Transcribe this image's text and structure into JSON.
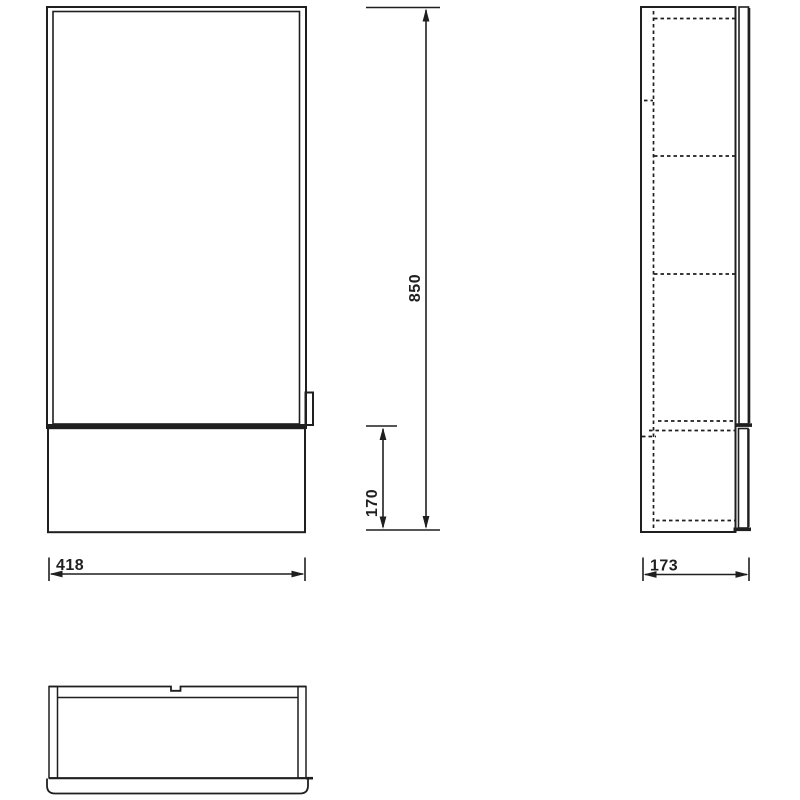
{
  "drawing": {
    "background_color": "#ffffff",
    "line_color": "#1f1f1f",
    "dimensions": {
      "overall_height": "850",
      "base_section_height": "170",
      "overall_width": "418",
      "overall_depth": "173"
    }
  }
}
